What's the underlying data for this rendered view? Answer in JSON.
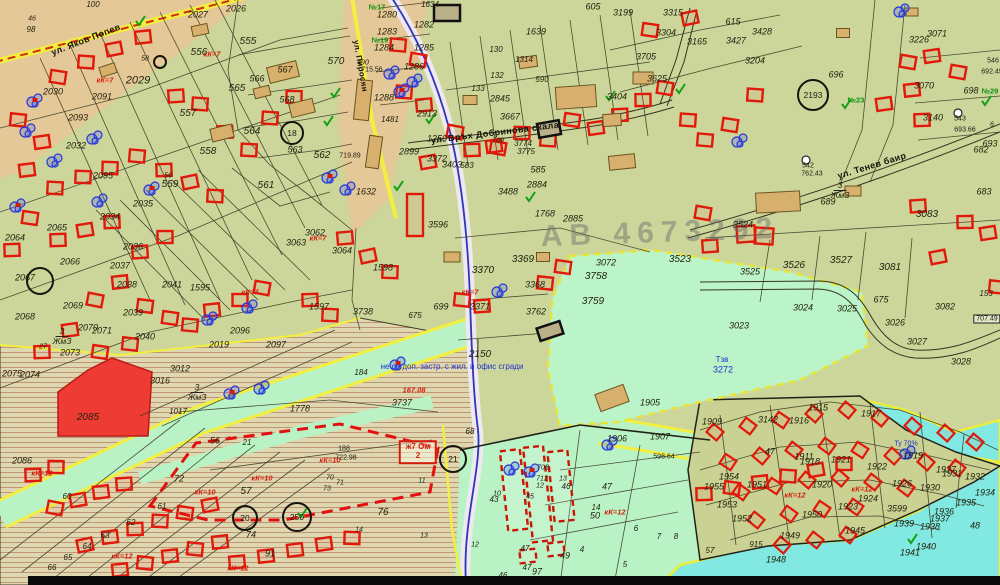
{
  "meta": {
    "watermark": "АВ 4673292"
  },
  "colors": {
    "base": "#ccd69b",
    "tan": "#e5c897",
    "mint": "#b9f3c5",
    "aqua": "#82e9e2",
    "red_zone": "#ee3b33",
    "building_red": "#e0190b",
    "yellow": "#f2ef3f",
    "blue_text": "#2431cf",
    "tan_building": "#d7b06e"
  },
  "streets": [
    {
      "name": "ул. Яков Попев",
      "x": 86,
      "y": 40,
      "rot": -21,
      "s": 9
    },
    {
      "name": "ул. Пиросян",
      "x": 360,
      "y": 66,
      "rot": 80,
      "s": 8
    },
    {
      "name": "ул. Връх Добринова скала",
      "x": 495,
      "y": 133,
      "rot": -7,
      "s": 9
    },
    {
      "name": "ул. Тенев баир",
      "x": 872,
      "y": 166,
      "rot": -17,
      "s": 9
    }
  ],
  "zones": [
    {
      "num": "3",
      "code": "ЖмЗ",
      "x": 62,
      "y": 336
    },
    {
      "num": "3",
      "code": "ЖмЗ",
      "x": 197,
      "y": 392
    },
    {
      "num": "3",
      "code": "ЖмЗ",
      "x": 840,
      "y": 190
    }
  ],
  "annotations": [
    {
      "t": "не се доп. застр. с жил. и офис сгради",
      "x": 452,
      "y": 367,
      "s": 8
    },
    {
      "t": "Тзв",
      "x": 722,
      "y": 360,
      "s": 8
    },
    {
      "t": "3272",
      "x": 723,
      "y": 370,
      "s": 9
    },
    {
      "t": "Ту 70%",
      "x": 906,
      "y": 444,
      "s": 7
    }
  ],
  "red_label_box": {
    "line1": "ж7 Ом",
    "line2": "2",
    "x": 418,
    "y": 452
  },
  "red_labels": [
    {
      "t": "кК=7",
      "x": 105,
      "y": 80
    },
    {
      "t": "кК=7",
      "x": 212,
      "y": 54
    },
    {
      "t": "кК=7",
      "x": 250,
      "y": 292
    },
    {
      "t": "кК=7",
      "x": 318,
      "y": 238
    },
    {
      "t": "кК=7",
      "x": 470,
      "y": 292
    },
    {
      "t": "кК=10",
      "x": 205,
      "y": 492
    },
    {
      "t": "кК=10",
      "x": 262,
      "y": 478
    },
    {
      "t": "кК=10",
      "x": 330,
      "y": 460
    },
    {
      "t": "кК=12",
      "x": 42,
      "y": 473
    },
    {
      "t": "кК=12",
      "x": 122,
      "y": 556
    },
    {
      "t": "кК=12",
      "x": 238,
      "y": 568
    },
    {
      "t": "кК=12",
      "x": 615,
      "y": 512
    },
    {
      "t": "кК=12",
      "x": 795,
      "y": 495
    },
    {
      "t": "кК=12",
      "x": 862,
      "y": 489
    },
    {
      "t": "167.08",
      "x": 414,
      "y": 390
    }
  ],
  "elevations": [
    {
      "t": "692.49",
      "x": 992,
      "y": 72
    },
    {
      "t": "693.66",
      "x": 965,
      "y": 130
    },
    {
      "t": "715.56",
      "x": 372,
      "y": 70
    },
    {
      "t": "719.89",
      "x": 350,
      "y": 156
    },
    {
      "t": "722.98",
      "x": 346,
      "y": 458
    },
    {
      "t": "762.43",
      "x": 812,
      "y": 174
    },
    {
      "t": "598.64",
      "x": 664,
      "y": 457
    },
    {
      "t": "707.49",
      "x": 987,
      "y": 319,
      "boxed": true
    },
    {
      "t": "542",
      "x": 808,
      "y": 166
    },
    {
      "t": "543",
      "x": 960,
      "y": 119
    },
    {
      "t": "546",
      "x": 993,
      "y": 61
    },
    {
      "t": "188",
      "x": 344,
      "y": 449
    }
  ],
  "circled": [
    {
      "t": "",
      "x": 40,
      "y": 281,
      "r": 13
    },
    {
      "t": "18",
      "x": 292,
      "y": 133,
      "r": 11
    },
    {
      "t": "2193",
      "x": 813,
      "y": 95,
      "r": 15
    },
    {
      "t": "20",
      "x": 245,
      "y": 518,
      "r": 12
    },
    {
      "t": "250",
      "x": 297,
      "y": 517,
      "r": 14
    },
    {
      "t": "21",
      "x": 453,
      "y": 459,
      "r": 13
    },
    {
      "t": "",
      "x": 160,
      "y": 62,
      "r": 6
    }
  ],
  "green_marks": [
    {
      "t": "№17",
      "x": 377,
      "y": 7
    },
    {
      "t": "№19",
      "x": 380,
      "y": 40
    },
    {
      "t": "№23",
      "x": 856,
      "y": 100
    },
    {
      "t": "№29",
      "x": 990,
      "y": 91
    }
  ],
  "parcels": [
    {
      "t": "46",
      "x": 32,
      "y": 19,
      "s": 7
    },
    {
      "t": "98",
      "x": 31,
      "y": 30,
      "s": 8
    },
    {
      "t": "100",
      "x": 93,
      "y": 5,
      "s": 8
    },
    {
      "t": "2026",
      "x": 236,
      "y": 9
    },
    {
      "t": "2027",
      "x": 198,
      "y": 15
    },
    {
      "t": "2029",
      "x": 138,
      "y": 81,
      "s": 11
    },
    {
      "t": "2030",
      "x": 53,
      "y": 92
    },
    {
      "t": "2091",
      "x": 102,
      "y": 97
    },
    {
      "t": "2093",
      "x": 78,
      "y": 118
    },
    {
      "t": "2032",
      "x": 76,
      "y": 146
    },
    {
      "t": "2095",
      "x": 103,
      "y": 176
    },
    {
      "t": "2034",
      "x": 110,
      "y": 217
    },
    {
      "t": "2035",
      "x": 143,
      "y": 204
    },
    {
      "t": "2036",
      "x": 133,
      "y": 247
    },
    {
      "t": "2037",
      "x": 120,
      "y": 266
    },
    {
      "t": "2038",
      "x": 127,
      "y": 285
    },
    {
      "t": "2039",
      "x": 133,
      "y": 313
    },
    {
      "t": "2040",
      "x": 145,
      "y": 337
    },
    {
      "t": "2041",
      "x": 172,
      "y": 285
    },
    {
      "t": "2064",
      "x": 15,
      "y": 238
    },
    {
      "t": "2065",
      "x": 57,
      "y": 228
    },
    {
      "t": "2066",
      "x": 70,
      "y": 262
    },
    {
      "t": "2067",
      "x": 25,
      "y": 278
    },
    {
      "t": "2068",
      "x": 25,
      "y": 317
    },
    {
      "t": "2069",
      "x": 73,
      "y": 306
    },
    {
      "t": "2070",
      "x": 88,
      "y": 328
    },
    {
      "t": "2071",
      "x": 102,
      "y": 331
    },
    {
      "t": "2073",
      "x": 70,
      "y": 353
    },
    {
      "t": "2074",
      "x": 30,
      "y": 375
    },
    {
      "t": "2075",
      "x": 12,
      "y": 374
    },
    {
      "t": "27",
      "x": 43,
      "y": 347,
      "s": 7
    },
    {
      "t": "2086",
      "x": 22,
      "y": 461
    },
    {
      "t": "555",
      "x": 248,
      "y": 42,
      "s": 10
    },
    {
      "t": "556",
      "x": 199,
      "y": 53,
      "s": 10
    },
    {
      "t": "557",
      "x": 188,
      "y": 114,
      "s": 10
    },
    {
      "t": "558",
      "x": 208,
      "y": 152,
      "s": 10
    },
    {
      "t": "559",
      "x": 170,
      "y": 185,
      "s": 10
    },
    {
      "t": "56",
      "x": 168,
      "y": 176,
      "s": 7
    },
    {
      "t": "561",
      "x": 266,
      "y": 186,
      "s": 10
    },
    {
      "t": "562",
      "x": 322,
      "y": 156,
      "s": 10
    },
    {
      "t": "563",
      "x": 295,
      "y": 150
    },
    {
      "t": "564",
      "x": 252,
      "y": 132,
      "s": 10
    },
    {
      "t": "565",
      "x": 237,
      "y": 89,
      "s": 10
    },
    {
      "t": "566",
      "x": 257,
      "y": 79
    },
    {
      "t": "567",
      "x": 285,
      "y": 70
    },
    {
      "t": "568",
      "x": 287,
      "y": 100
    },
    {
      "t": "570",
      "x": 336,
      "y": 62,
      "s": 10
    },
    {
      "t": "58",
      "x": 145,
      "y": 59,
      "s": 7
    },
    {
      "t": "1634",
      "x": 430,
      "y": 5,
      "s": 8
    },
    {
      "t": "1280",
      "x": 387,
      "y": 15
    },
    {
      "t": "1282",
      "x": 424,
      "y": 25
    },
    {
      "t": "1283",
      "x": 387,
      "y": 32
    },
    {
      "t": "1284",
      "x": 384,
      "y": 48
    },
    {
      "t": "1285",
      "x": 424,
      "y": 48
    },
    {
      "t": "1286",
      "x": 414,
      "y": 67
    },
    {
      "t": "1288",
      "x": 384,
      "y": 98
    },
    {
      "t": "490",
      "x": 363,
      "y": 63,
      "s": 7
    },
    {
      "t": "1481",
      "x": 390,
      "y": 120,
      "s": 8
    },
    {
      "t": "2913",
      "x": 427,
      "y": 114
    },
    {
      "t": "1250",
      "x": 437,
      "y": 139
    },
    {
      "t": "2899",
      "x": 409,
      "y": 152
    },
    {
      "t": "1632",
      "x": 366,
      "y": 192
    },
    {
      "t": "605",
      "x": 593,
      "y": 7
    },
    {
      "t": "3199",
      "x": 623,
      "y": 13
    },
    {
      "t": "3315",
      "x": 673,
      "y": 13
    },
    {
      "t": "3304",
      "x": 666,
      "y": 33
    },
    {
      "t": "3165",
      "x": 697,
      "y": 42
    },
    {
      "t": "3204",
      "x": 755,
      "y": 61
    },
    {
      "t": "3705",
      "x": 646,
      "y": 57
    },
    {
      "t": "130",
      "x": 496,
      "y": 50,
      "s": 8
    },
    {
      "t": "1314",
      "x": 524,
      "y": 60,
      "s": 8
    },
    {
      "t": "132",
      "x": 497,
      "y": 76,
      "s": 8
    },
    {
      "t": "133",
      "x": 478,
      "y": 89,
      "s": 8
    },
    {
      "t": "590",
      "x": 542,
      "y": 80,
      "s": 8
    },
    {
      "t": "2845",
      "x": 500,
      "y": 99
    },
    {
      "t": "3667",
      "x": 510,
      "y": 117
    },
    {
      "t": "1639",
      "x": 536,
      "y": 32
    },
    {
      "t": "3625",
      "x": 657,
      "y": 79
    },
    {
      "t": "3404",
      "x": 617,
      "y": 97
    },
    {
      "t": "3372",
      "x": 437,
      "y": 159
    },
    {
      "t": "3403",
      "x": 452,
      "y": 165
    },
    {
      "t": "583",
      "x": 467,
      "y": 166,
      "s": 8
    },
    {
      "t": "585",
      "x": 538,
      "y": 170
    },
    {
      "t": "3488",
      "x": 508,
      "y": 192
    },
    {
      "t": "2884",
      "x": 537,
      "y": 185
    },
    {
      "t": "709",
      "x": 498,
      "y": 141,
      "s": 7
    },
    {
      "t": "3774",
      "x": 523,
      "y": 144,
      "s": 8
    },
    {
      "t": "3775",
      "x": 526,
      "y": 152,
      "s": 8
    },
    {
      "t": "1768",
      "x": 545,
      "y": 214
    },
    {
      "t": "2885",
      "x": 573,
      "y": 219
    },
    {
      "t": "693",
      "x": 990,
      "y": 144
    },
    {
      "t": "615",
      "x": 733,
      "y": 22
    },
    {
      "t": "3428",
      "x": 762,
      "y": 32
    },
    {
      "t": "3427",
      "x": 736,
      "y": 41
    },
    {
      "t": "3226",
      "x": 919,
      "y": 40
    },
    {
      "t": "3071",
      "x": 937,
      "y": 34
    },
    {
      "t": "696",
      "x": 836,
      "y": 75
    },
    {
      "t": "3070",
      "x": 924,
      "y": 86
    },
    {
      "t": "698",
      "x": 971,
      "y": 91
    },
    {
      "t": "3140",
      "x": 933,
      "y": 118
    },
    {
      "t": "682",
      "x": 981,
      "y": 150
    },
    {
      "t": "683",
      "x": 984,
      "y": 192
    },
    {
      "t": "689",
      "x": 828,
      "y": 202
    },
    {
      "t": "6",
      "x": 992,
      "y": 125,
      "s": 7
    },
    {
      "t": "3596",
      "x": 438,
      "y": 225
    },
    {
      "t": "3370",
      "x": 483,
      "y": 271,
      "s": 10
    },
    {
      "t": "3369",
      "x": 523,
      "y": 260,
      "s": 10
    },
    {
      "t": "3371",
      "x": 480,
      "y": 307
    },
    {
      "t": "3762",
      "x": 536,
      "y": 312
    },
    {
      "t": "3759",
      "x": 593,
      "y": 302,
      "s": 10
    },
    {
      "t": "3758",
      "x": 596,
      "y": 277,
      "s": 10
    },
    {
      "t": "3072",
      "x": 606,
      "y": 263
    },
    {
      "t": "3523",
      "x": 680,
      "y": 260,
      "s": 10
    },
    {
      "t": "3368",
      "x": 535,
      "y": 285
    },
    {
      "t": "699",
      "x": 441,
      "y": 307
    },
    {
      "t": "675",
      "x": 415,
      "y": 316,
      "s": 8
    },
    {
      "t": "3738",
      "x": 363,
      "y": 312
    },
    {
      "t": "1598",
      "x": 383,
      "y": 268
    },
    {
      "t": "1595",
      "x": 200,
      "y": 288
    },
    {
      "t": "1597",
      "x": 319,
      "y": 307
    },
    {
      "t": "2096",
      "x": 240,
      "y": 331
    },
    {
      "t": "2097",
      "x": 276,
      "y": 345
    },
    {
      "t": "2019",
      "x": 219,
      "y": 345
    },
    {
      "t": "3012",
      "x": 180,
      "y": 369
    },
    {
      "t": "3016",
      "x": 160,
      "y": 381
    },
    {
      "t": "2150",
      "x": 480,
      "y": 355,
      "s": 10
    },
    {
      "t": "184",
      "x": 361,
      "y": 373,
      "s": 8
    },
    {
      "t": "3524",
      "x": 743,
      "y": 225
    },
    {
      "t": "3525",
      "x": 750,
      "y": 272
    },
    {
      "t": "3526",
      "x": 794,
      "y": 266,
      "s": 10
    },
    {
      "t": "3527",
      "x": 841,
      "y": 261,
      "s": 10
    },
    {
      "t": "3081",
      "x": 890,
      "y": 268,
      "s": 10
    },
    {
      "t": "3083",
      "x": 927,
      "y": 215,
      "s": 10
    },
    {
      "t": "3082",
      "x": 945,
      "y": 307
    },
    {
      "t": "3023",
      "x": 739,
      "y": 326
    },
    {
      "t": "3024",
      "x": 803,
      "y": 308
    },
    {
      "t": "3025",
      "x": 847,
      "y": 309
    },
    {
      "t": "3026",
      "x": 895,
      "y": 323
    },
    {
      "t": "3027",
      "x": 917,
      "y": 342
    },
    {
      "t": "3028",
      "x": 961,
      "y": 362
    },
    {
      "t": "153",
      "x": 986,
      "y": 294,
      "s": 8
    },
    {
      "t": "675",
      "x": 881,
      "y": 300
    },
    {
      "t": "3062",
      "x": 315,
      "y": 233
    },
    {
      "t": "3063",
      "x": 296,
      "y": 243
    },
    {
      "t": "3064",
      "x": 342,
      "y": 251
    },
    {
      "t": "1017",
      "x": 178,
      "y": 412,
      "s": 8
    },
    {
      "t": "1778",
      "x": 300,
      "y": 409
    },
    {
      "t": "3737",
      "x": 402,
      "y": 403
    },
    {
      "t": "68",
      "x": 470,
      "y": 432,
      "s": 8
    },
    {
      "t": "56",
      "x": 215,
      "y": 441
    },
    {
      "t": "21",
      "x": 247,
      "y": 443,
      "s": 8
    },
    {
      "t": "57",
      "x": 246,
      "y": 492,
      "s": 10
    },
    {
      "t": "72",
      "x": 179,
      "y": 479
    },
    {
      "t": "60",
      "x": 67,
      "y": 497,
      "s": 8
    },
    {
      "t": "61",
      "x": 162,
      "y": 507,
      "s": 8
    },
    {
      "t": "62",
      "x": 131,
      "y": 523,
      "s": 8
    },
    {
      "t": "63",
      "x": 105,
      "y": 536,
      "s": 8
    },
    {
      "t": "64",
      "x": 87,
      "y": 547,
      "s": 8
    },
    {
      "t": "65",
      "x": 68,
      "y": 558,
      "s": 8
    },
    {
      "t": "66",
      "x": 52,
      "y": 568,
      "s": 8
    },
    {
      "t": "70",
      "x": 330,
      "y": 478,
      "s": 7
    },
    {
      "t": "71",
      "x": 340,
      "y": 483,
      "s": 7
    },
    {
      "t": "73",
      "x": 327,
      "y": 489,
      "s": 7
    },
    {
      "t": "74",
      "x": 251,
      "y": 535
    },
    {
      "t": "91",
      "x": 270,
      "y": 554
    },
    {
      "t": "11",
      "x": 422,
      "y": 481,
      "s": 7
    },
    {
      "t": "14",
      "x": 359,
      "y": 530,
      "s": 7
    },
    {
      "t": "13",
      "x": 424,
      "y": 536,
      "s": 7
    },
    {
      "t": "12",
      "x": 475,
      "y": 545,
      "s": 7
    },
    {
      "t": "76",
      "x": 383,
      "y": 513,
      "s": 10
    },
    {
      "t": "10",
      "x": 497,
      "y": 494,
      "s": 7
    },
    {
      "t": "43",
      "x": 494,
      "y": 500,
      "s": 8
    },
    {
      "t": "708",
      "x": 543,
      "y": 468,
      "s": 7
    },
    {
      "t": "712",
      "x": 542,
      "y": 479,
      "s": 7
    },
    {
      "t": "12",
      "x": 540,
      "y": 486,
      "s": 7
    },
    {
      "t": "13",
      "x": 563,
      "y": 479,
      "s": 7
    },
    {
      "t": "46",
      "x": 566,
      "y": 487,
      "s": 8
    },
    {
      "t": "45",
      "x": 530,
      "y": 497,
      "s": 7
    },
    {
      "t": "49",
      "x": 565,
      "y": 556
    },
    {
      "t": "47",
      "x": 525,
      "y": 549,
      "s": 8
    },
    {
      "t": "47",
      "x": 527,
      "y": 568,
      "s": 8
    },
    {
      "t": "46",
      "x": 503,
      "y": 576,
      "s": 8
    },
    {
      "t": "97",
      "x": 537,
      "y": 572
    },
    {
      "t": "47",
      "x": 607,
      "y": 487
    },
    {
      "t": "47",
      "x": 770,
      "y": 452
    },
    {
      "t": "14",
      "x": 596,
      "y": 508,
      "s": 8
    },
    {
      "t": "50",
      "x": 595,
      "y": 516
    },
    {
      "t": "6",
      "x": 636,
      "y": 529,
      "s": 8
    },
    {
      "t": "4",
      "x": 582,
      "y": 550,
      "s": 8
    },
    {
      "t": "5",
      "x": 625,
      "y": 565,
      "s": 8
    },
    {
      "t": "7",
      "x": 659,
      "y": 537,
      "s": 8
    },
    {
      "t": "8",
      "x": 676,
      "y": 537,
      "s": 8
    },
    {
      "t": "1905",
      "x": 650,
      "y": 403
    },
    {
      "t": "1906",
      "x": 617,
      "y": 439
    },
    {
      "t": "1907",
      "x": 660,
      "y": 437
    },
    {
      "t": "1909",
      "x": 712,
      "y": 422
    },
    {
      "t": "1911",
      "x": 804,
      "y": 457
    },
    {
      "t": "3142",
      "x": 768,
      "y": 420
    },
    {
      "t": "1915",
      "x": 818,
      "y": 408
    },
    {
      "t": "1916",
      "x": 799,
      "y": 421
    },
    {
      "t": "1917",
      "x": 871,
      "y": 414
    },
    {
      "t": "1918",
      "x": 810,
      "y": 462
    },
    {
      "t": "1921",
      "x": 841,
      "y": 460
    },
    {
      "t": "1919",
      "x": 913,
      "y": 456
    },
    {
      "t": "1920",
      "x": 822,
      "y": 485
    },
    {
      "t": "1922",
      "x": 877,
      "y": 467
    },
    {
      "t": "1923",
      "x": 848,
      "y": 507
    },
    {
      "t": "1924",
      "x": 868,
      "y": 499
    },
    {
      "t": "1926",
      "x": 902,
      "y": 484
    },
    {
      "t": "1927",
      "x": 946,
      "y": 470
    },
    {
      "t": "1930",
      "x": 930,
      "y": 488
    },
    {
      "t": "1931",
      "x": 952,
      "y": 474
    },
    {
      "t": "1932",
      "x": 975,
      "y": 477
    },
    {
      "t": "1934",
      "x": 985,
      "y": 493
    },
    {
      "t": "1935",
      "x": 966,
      "y": 503
    },
    {
      "t": "1936",
      "x": 944,
      "y": 512
    },
    {
      "t": "1937",
      "x": 940,
      "y": 519
    },
    {
      "t": "1938",
      "x": 930,
      "y": 527
    },
    {
      "t": "1939",
      "x": 904,
      "y": 524
    },
    {
      "t": "1940",
      "x": 926,
      "y": 547
    },
    {
      "t": "1941",
      "x": 910,
      "y": 553
    },
    {
      "t": "3599",
      "x": 897,
      "y": 509
    },
    {
      "t": "1945",
      "x": 855,
      "y": 531
    },
    {
      "t": "1948",
      "x": 776,
      "y": 560
    },
    {
      "t": "1949",
      "x": 790,
      "y": 536
    },
    {
      "t": "1950",
      "x": 812,
      "y": 515
    },
    {
      "t": "1951",
      "x": 757,
      "y": 485
    },
    {
      "t": "1952",
      "x": 742,
      "y": 519
    },
    {
      "t": "1953",
      "x": 727,
      "y": 505
    },
    {
      "t": "1954",
      "x": 729,
      "y": 477
    },
    {
      "t": "1955",
      "x": 714,
      "y": 487
    },
    {
      "t": "915",
      "x": 756,
      "y": 545,
      "s": 8
    },
    {
      "t": "57",
      "x": 710,
      "y": 551,
      "s": 8
    },
    {
      "t": "48",
      "x": 975,
      "y": 526
    },
    {
      "t": "2085",
      "x": 88,
      "y": 418,
      "s": 10
    }
  ]
}
